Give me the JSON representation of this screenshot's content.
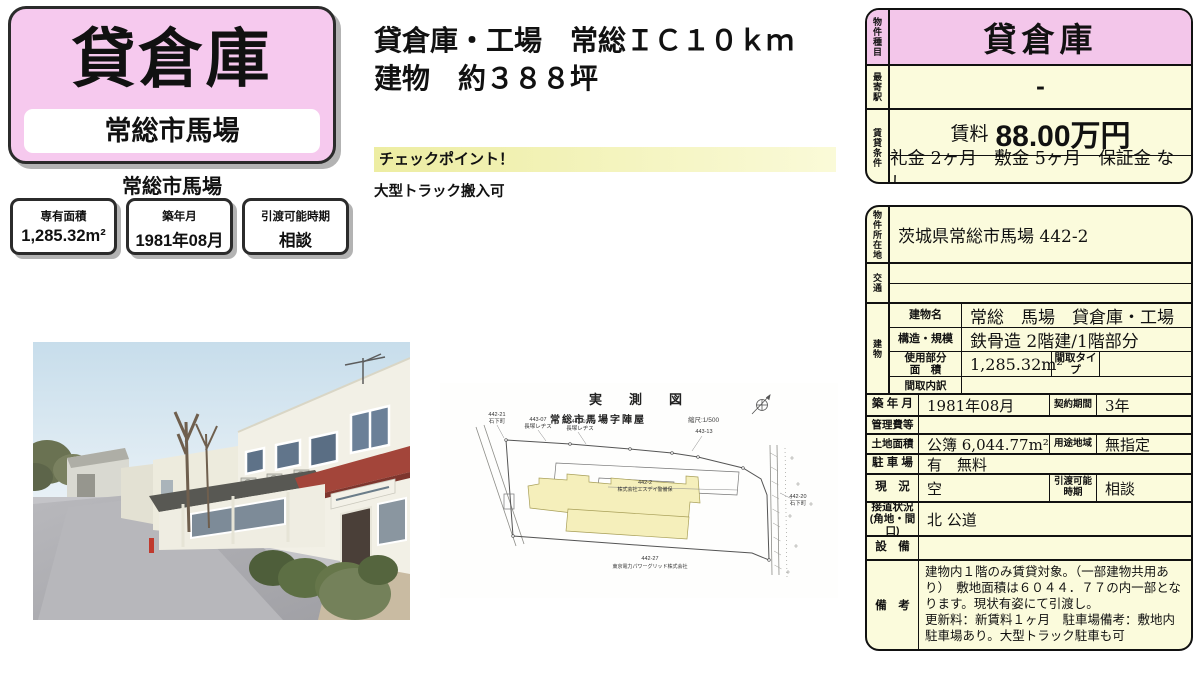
{
  "flyer": {
    "title": "貸倉庫",
    "title_location": "常総市馬場",
    "location_caption": "常総市馬場",
    "info_boxes": [
      {
        "label": "専有面積",
        "value": "1,285.32m²"
      },
      {
        "label": "築年月",
        "value": "1981年08月"
      },
      {
        "label": "引渡可能時期",
        "value": "相談"
      }
    ],
    "headline1": "貸倉庫・工場　常総ＩＣ１０ｋｍ",
    "headline2": "建物　約３８８坪",
    "checkpoint_title": "チェックポイント！",
    "checkpoint_body": "大型トラック搬入可"
  },
  "summary_table": {
    "type_label": "物件種目",
    "type_value": "貸倉庫",
    "station_label": "最寄駅",
    "station_value": "-",
    "terms_label": "賃貸条件",
    "rent_label": "賃料",
    "rent_value": "88.00万円",
    "terms_value": "礼金 2ヶ月　敷金 5ヶ月　保証金 なし"
  },
  "detail_table": {
    "address_label": "物件所在地",
    "address_value": "茨城県常総市馬場 442-2",
    "access_label": "交通",
    "access_line1": "",
    "access_line2": "",
    "building_label": "建物",
    "building_name_label": "建物名",
    "building_name": "常総　馬場　貸倉庫・工場",
    "structure_label": "構造・規模",
    "structure_value": "鉄骨造 2階建/1階部分",
    "area_label": "使用部分\n面　積",
    "area_value": "1,285.32m²",
    "layout_type_label": "間取タイプ",
    "layout_type_value": "",
    "layout_detail_label": "間取内訳",
    "layout_detail_value": "",
    "built_label": "築 年 月",
    "built_value": "1981年08月",
    "contract_label": "契約期間",
    "contract_value": "3年",
    "fees_label": "管理費等",
    "fees_value": "",
    "land_label": "土地面積",
    "land_value": "公簿 6,044.77m²",
    "zoning_label": "用途地域",
    "zoning_value": "無指定",
    "parking_label": "駐 車 場",
    "parking_value": "有　無料",
    "status_label": "現　況",
    "status_value": "空",
    "handover_label": "引渡可能\n時期",
    "handover_value": "相談",
    "road_label": "接道状況\n(角地・間口)",
    "road_value": "北 公道",
    "equipment_label": "設　備",
    "equipment_value": "",
    "remarks_label": "備　考",
    "remarks_value": "建物内１階のみ賃貸対象。（一部建物共用あり）　敷地面積は６０４４．７７の内一部となります。現状有姿にて引渡し。\n更新料：新賃料１ヶ月　駐車場備考：敷地内駐車場あり。大型トラック駐車も可"
  },
  "plan": {
    "title": "実　測　図",
    "area_name": "常総市馬場字陣屋",
    "scale": "縮尺:1/500",
    "labels": {
      "l1a": "442-21",
      "l1b": "石下町",
      "l2a": "443-07",
      "l2b": "長塚レヂス",
      "l3a": "443-10",
      "l3b": "長塚レヂス",
      "l4a": "443-13",
      "c1": "442-2",
      "c2": "株式会社エスデイ警備保",
      "b1": "442-27",
      "b2": "東京電力パワーグリッド株式会社",
      "r1": "442-20",
      "r2": "石下町"
    }
  },
  "colors": {
    "pink": "#f6c9ee",
    "cream": "#fbfbdc",
    "awning_red": "#a3453a"
  }
}
